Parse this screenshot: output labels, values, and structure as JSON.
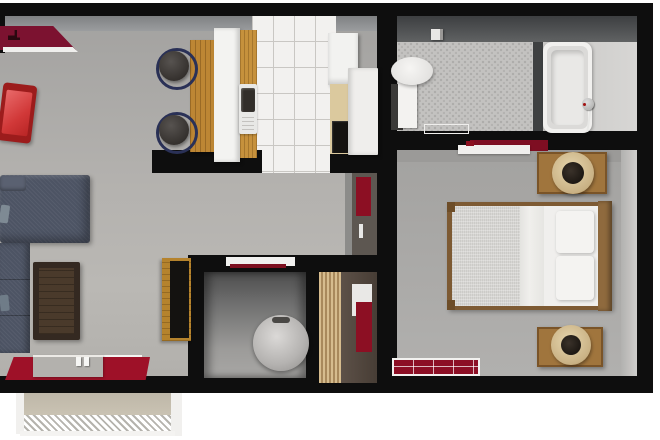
{
  "scene": {
    "description": "3D rendered top-down floor plan of a one-bedroom apartment",
    "background_color": "#ffffff",
    "wall_color": "#0e0e0e"
  },
  "rooms": [
    {
      "name": "living-room",
      "floor_color": "#b3b1ae",
      "furniture": [
        "sectional-sofa",
        "red-accent-chair",
        "coffee-table",
        "tv-console",
        "maroon-wall-console",
        "red-area-rug",
        "entry-bench-with-candles"
      ]
    },
    {
      "name": "kitchen",
      "floor_color": "#f2f1ef",
      "furniture": [
        "breakfast-bar",
        "two-bar-stools",
        "sink",
        "upper-cabinet",
        "refrigerator",
        "cooktop-counter"
      ]
    },
    {
      "name": "bathroom",
      "floor_color": "#c3c2c0",
      "furniture": [
        "toilet",
        "bathtub",
        "hand-shower",
        "bath-mat",
        "paper-holder"
      ]
    },
    {
      "name": "bedroom",
      "floor_color": "#a9a8a6",
      "furniture": [
        "double-bed",
        "nightstand-with-lamp-north",
        "nightstand-with-lamp-south",
        "grid-rug",
        "door-mat-rug",
        "door-leaf"
      ]
    },
    {
      "name": "utility-closet",
      "furniture": [
        "water-heater",
        "white-door-leaf"
      ]
    },
    {
      "name": "wardrobe-closet",
      "furniture": [
        "louvered-door",
        "hanging-red-clothes"
      ]
    },
    {
      "name": "hall-niche",
      "furniture": [
        "hanging-red-clothes"
      ]
    }
  ],
  "exterior": {
    "feature": "entry-stoop-with-striped-doormat",
    "stoop_color": "#c6bfb0"
  },
  "colors": {
    "sofa_upholstery": "#4d5464",
    "accent_chair_red": "#d13838",
    "dark_red_textile": "#8c0f23",
    "bar_wood": "#bd8634",
    "nightstand_wood": "#a0753d",
    "white_fixtures": "#f1f0ee",
    "water_heater_gray": "#b5b3b1",
    "louver_tan": "#d6bc8e",
    "tile_grout": "#c9c7c3"
  }
}
